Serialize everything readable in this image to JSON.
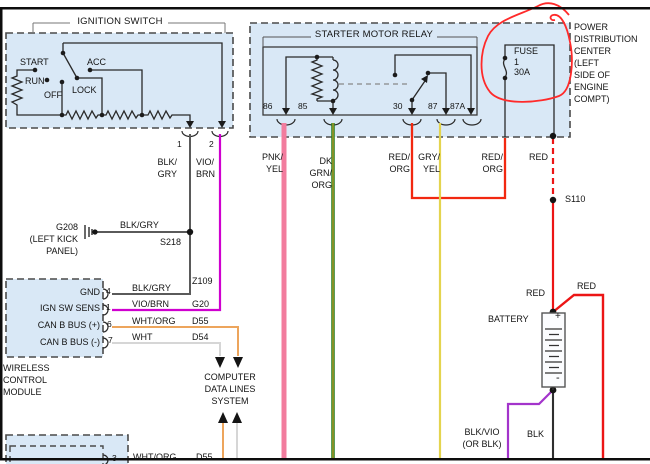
{
  "colors": {
    "diagram_box_fill": "#d9e8f6",
    "dashed_border": "#4a4a4a",
    "line": "#2a2a2a",
    "pnk_yel": "#f27c9e",
    "dk_grn": "#237d23",
    "grn_core": "#d8a32a",
    "vio_brn": "#cf00cf",
    "wht_org": "#eda55c",
    "wht": "#d6d6d6",
    "blk_gry": "#5a5a5a",
    "gry_yel": "#e4d44e",
    "red": "#ec1515",
    "red_org": "#f22810",
    "blk_vio": "#a334cb",
    "blk": "#2f2f2f",
    "annotation": "#ff2a2a"
  },
  "ignition": {
    "title": "IGNITION SWITCH",
    "pos_start": "START",
    "pos_run": "RUN",
    "pos_off": "OFF",
    "pos_lock": "LOCK",
    "pos_acc": "ACC",
    "pin1": "1",
    "pin2": "2",
    "wire1": "BLK/\nGRY",
    "wire2": "VIO/\nBRN"
  },
  "ground": {
    "name": "G208\n(LEFT KICK\nPANEL)",
    "wire": "BLK/GRY",
    "splice": "S218"
  },
  "relay": {
    "title": "STARTER MOTOR RELAY",
    "pin86": "86",
    "pin85": "85",
    "pin30": "30",
    "pin87": "87",
    "pin87a": "87A"
  },
  "pdc": {
    "label": "POWER\nDISTRIBUTION\nCENTER\n(LEFT\nSIDE OF\nENGINE\nCOMPT)",
    "fuse": "FUSE\n1\n30A"
  },
  "wire_labels": {
    "pnk_yel": "PNK/\nYEL",
    "dk_grn_org": "DK\nGRN/\nORG",
    "red_org_30": "RED/\nORG",
    "gry_yel": "GRY/\nYEL",
    "red_org_fuse": "RED/\nORG",
    "red_fuse": "RED",
    "splice": "S110",
    "red_batt": "RED",
    "red_out": "RED",
    "blk_vio": "BLK/VIO\n(OR BLK)",
    "blk": "BLK"
  },
  "module": {
    "label": "WIRELESS\nCONTROL\nMODULE",
    "rows": [
      {
        "name": "GND",
        "pin": "4",
        "wire": "BLK/GRY",
        "dest": "Z109"
      },
      {
        "name": "IGN SW SENS",
        "pin": "1",
        "wire": "VIO/BRN",
        "dest": "G20"
      },
      {
        "name": "CAN B BUS (+)",
        "pin": "6",
        "wire": "WHT/ORG",
        "dest": "D55"
      },
      {
        "name": "CAN B BUS (-)",
        "pin": "7",
        "wire": "WHT",
        "dest": "D54"
      }
    ]
  },
  "computer": {
    "label": "COMPUTER\nDATA LINES\nSYSTEM"
  },
  "battery": {
    "label": "BATTERY",
    "plus": "+",
    "minus": "-"
  },
  "bottom_module": {
    "pin": "3",
    "wire": "WHT/ORG",
    "dest": "D55"
  }
}
